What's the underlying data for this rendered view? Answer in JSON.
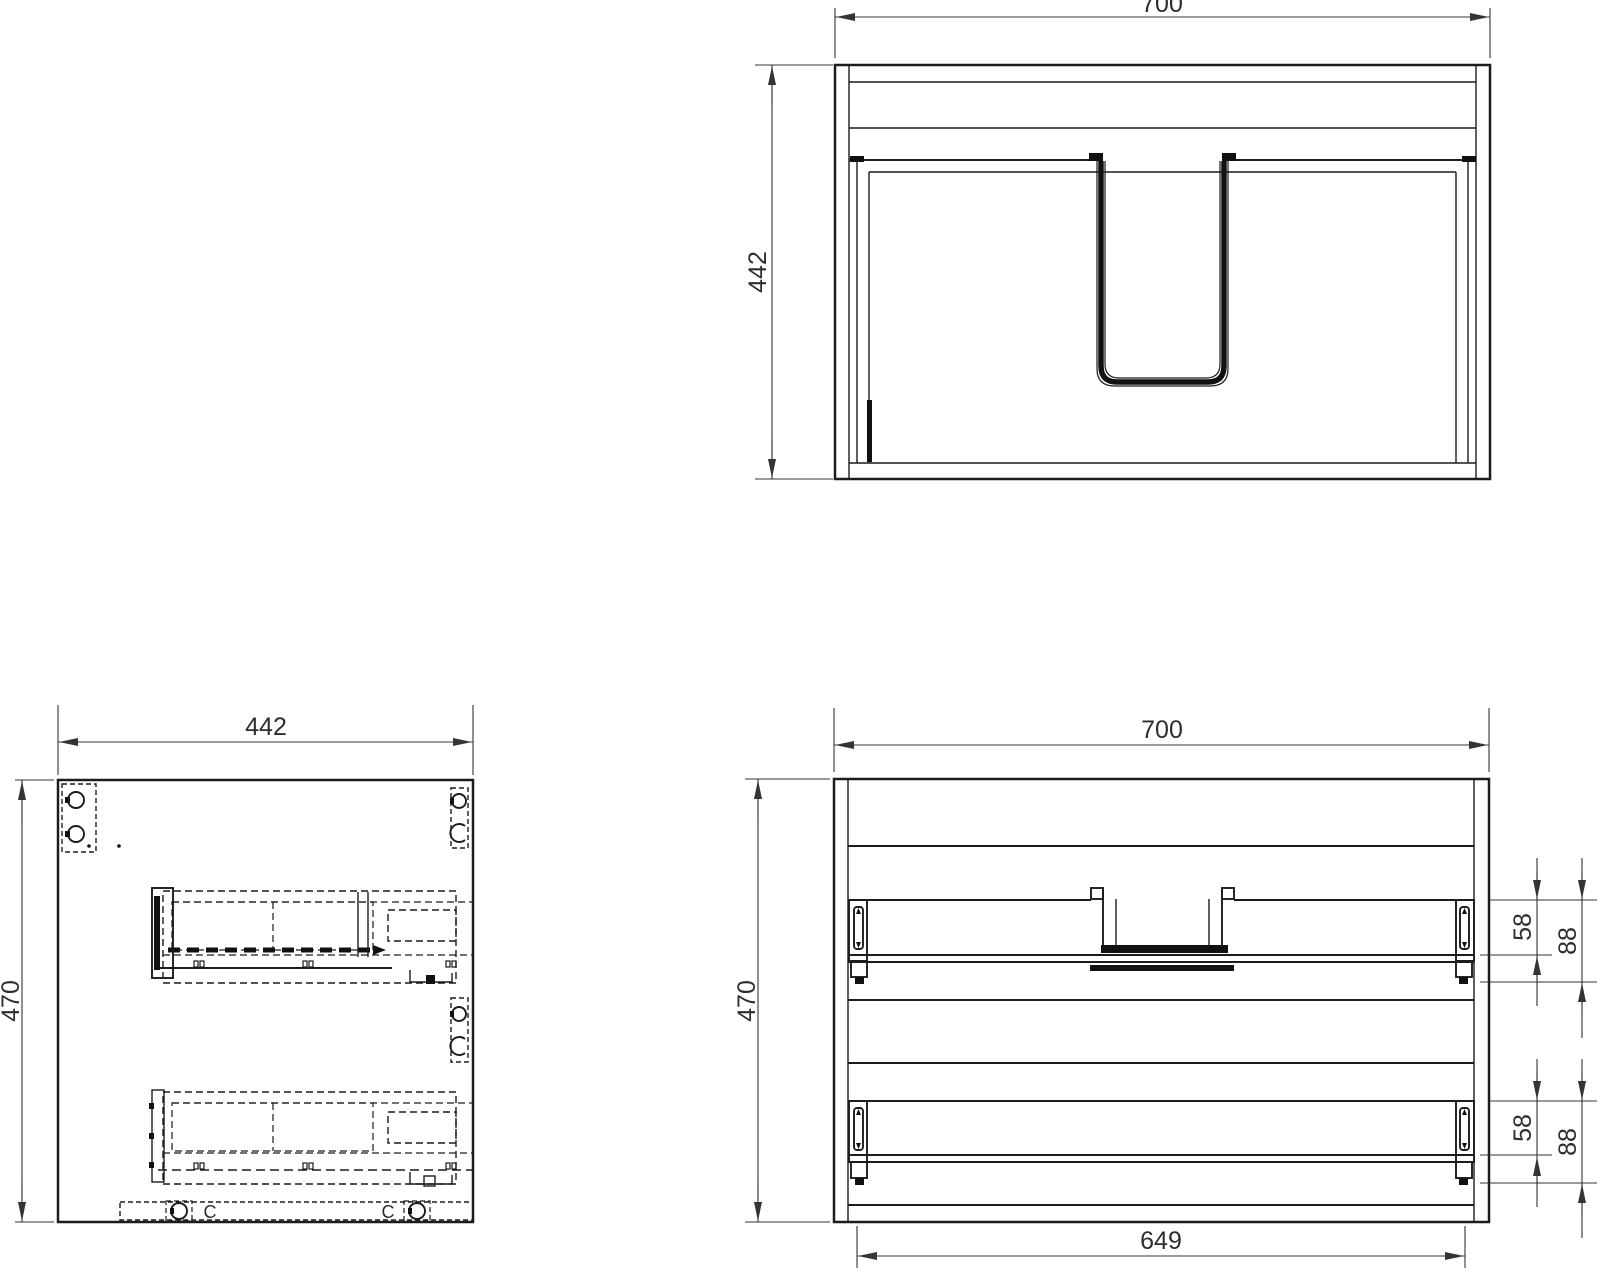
{
  "drawing": {
    "type": "cabinet-technical-drawing",
    "colors": {
      "background": "#ffffff",
      "line": "#1c1c1e",
      "dimension": "#343436"
    }
  },
  "top_view": {
    "dim_width": "700",
    "dim_depth": "442"
  },
  "side_view": {
    "dim_width": "442",
    "dim_height": "470",
    "cam_labels": [
      "C",
      "C"
    ]
  },
  "front_view": {
    "dim_width": "700",
    "dim_height": "470",
    "dim_inner_width": "649",
    "upper_rail": {
      "offset_to_shelf": "58",
      "offset_to_base": "88"
    },
    "lower_rail": {
      "offset_to_shelf": "58",
      "offset_to_base": "88"
    }
  }
}
